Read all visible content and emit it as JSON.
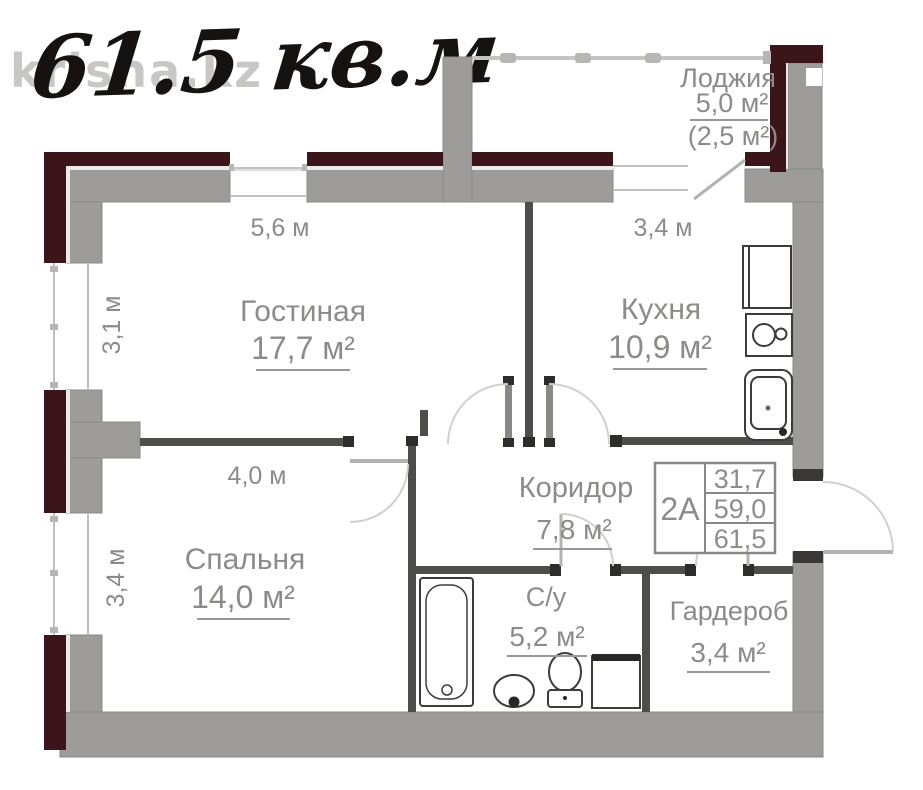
{
  "watermark": "krisha.kz",
  "title": "61.5 кв.м",
  "rooms": {
    "living": {
      "name": "Гостиная",
      "area": "17,7 м²"
    },
    "kitchen": {
      "name": "Кухня",
      "area": "10,9 м²"
    },
    "loggia": {
      "name": "Лоджия",
      "area": "5,0 м²",
      "area_reduced": "(2,5 м²)"
    },
    "corridor": {
      "name": "Коридор",
      "area": "7,8 м²"
    },
    "bedroom": {
      "name": "Спальня",
      "area": "14,0 м²"
    },
    "bathroom": {
      "name": "С/у",
      "area": "5,2 м²"
    },
    "wardrobe": {
      "name": "Гардероб",
      "area": "3,4 м²"
    }
  },
  "dimensions": {
    "living_width": "5,6 м",
    "living_depth": "3,1 м",
    "kitchen_width": "3,4 м",
    "bedroom_width": "4,0 м",
    "bedroom_depth": "3,4 м"
  },
  "info_table": {
    "unit_label": "2А",
    "values": [
      "31,7",
      "59,0",
      "61,5"
    ]
  },
  "fixtures": [
    "fridge",
    "stove",
    "kitchen-sink",
    "bathtub",
    "wash-basin",
    "toilet",
    "washing-machine"
  ],
  "colors": {
    "outer_wall": "#3b151a",
    "inner_wall": "#9e9c9a",
    "partition": "#4f4d4b",
    "label_gray": "#8d8b89"
  }
}
